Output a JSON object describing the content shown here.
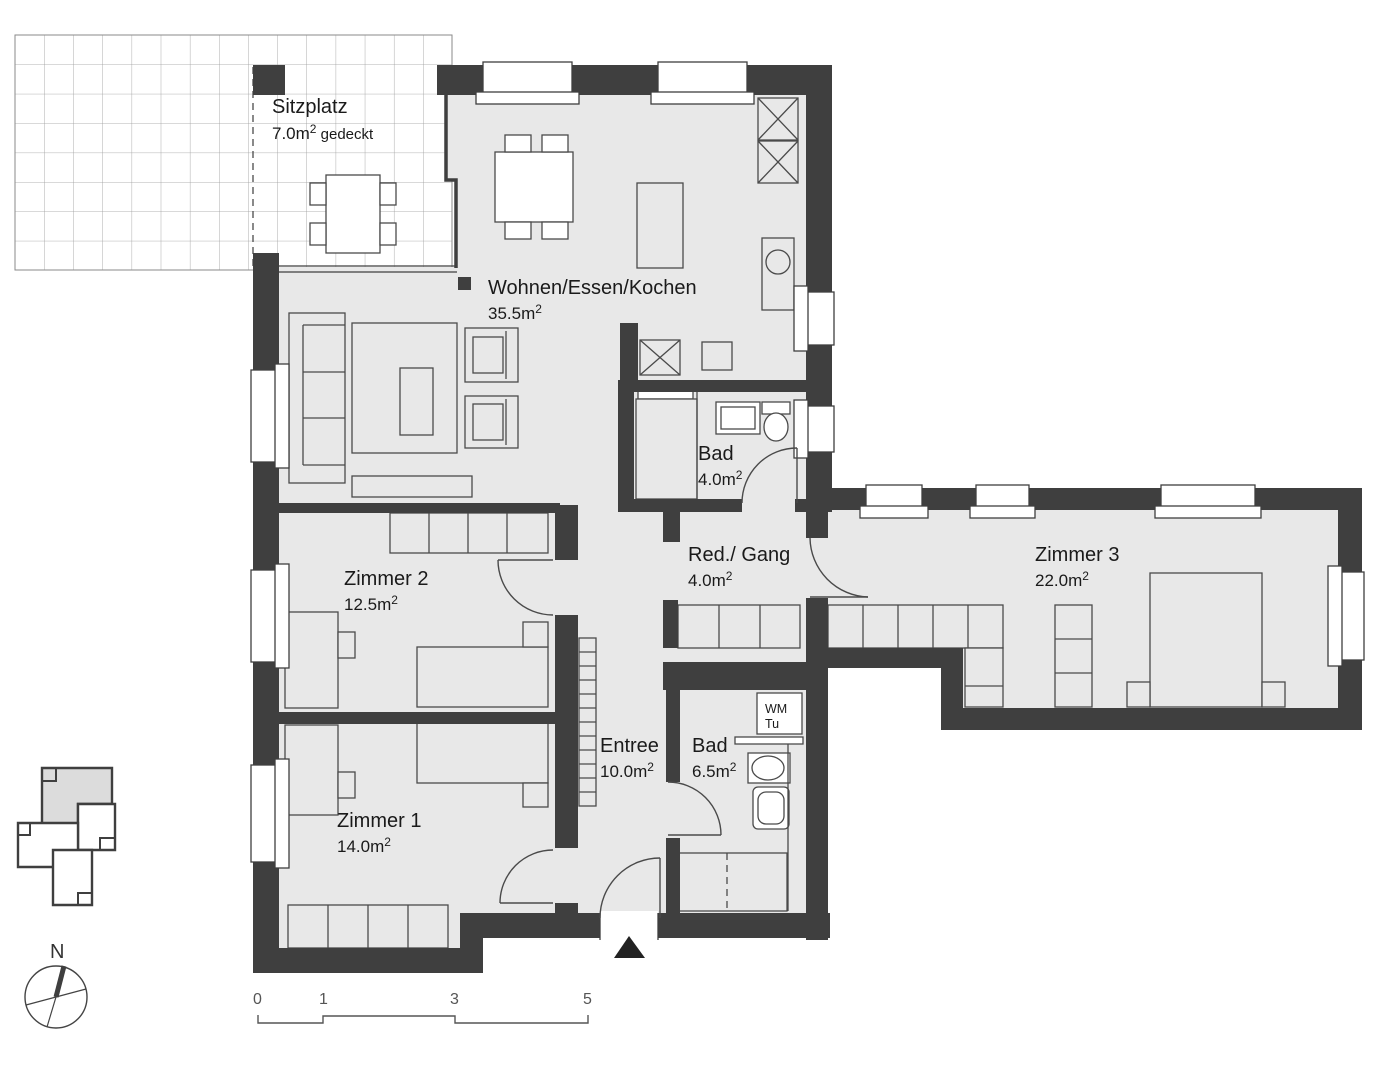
{
  "colors": {
    "wall": "#3f3f3f",
    "floor": "#e8e8e8",
    "line": "#4a4a4a",
    "text": "#1a1a1a",
    "grid": "#9a9a9a",
    "scale": "#555555",
    "hl": "#dcdcdc"
  },
  "rooms": {
    "sitzplatz": {
      "name": "Sitzplatz",
      "area": "7.0m",
      "sup": "2",
      "suffix": " gedeckt"
    },
    "wohnen": {
      "name": "Wohnen/Essen/Kochen",
      "area": "35.5m",
      "sup": "2"
    },
    "bad_klein": {
      "name": "Bad",
      "area": "4.0m",
      "sup": "2"
    },
    "gang": {
      "name": "Red./ Gang",
      "area": "4.0m",
      "sup": "2"
    },
    "zimmer3": {
      "name": "Zimmer 3",
      "area": "22.0m",
      "sup": "2"
    },
    "zimmer2": {
      "name": "Zimmer 2",
      "area": "12.5m",
      "sup": "2"
    },
    "entree": {
      "name": "Entree",
      "area": "10.0m",
      "sup": "2"
    },
    "bad_gross": {
      "name": "Bad",
      "area": "6.5m",
      "sup": "2"
    },
    "zimmer1": {
      "name": "Zimmer 1",
      "area": "14.0m",
      "sup": "2"
    }
  },
  "fixtures": {
    "wm": "WM",
    "tu": "Tu"
  },
  "compass": {
    "north": "N"
  },
  "scale_bar": {
    "ticks": [
      "0",
      "1",
      "3",
      "5"
    ]
  }
}
